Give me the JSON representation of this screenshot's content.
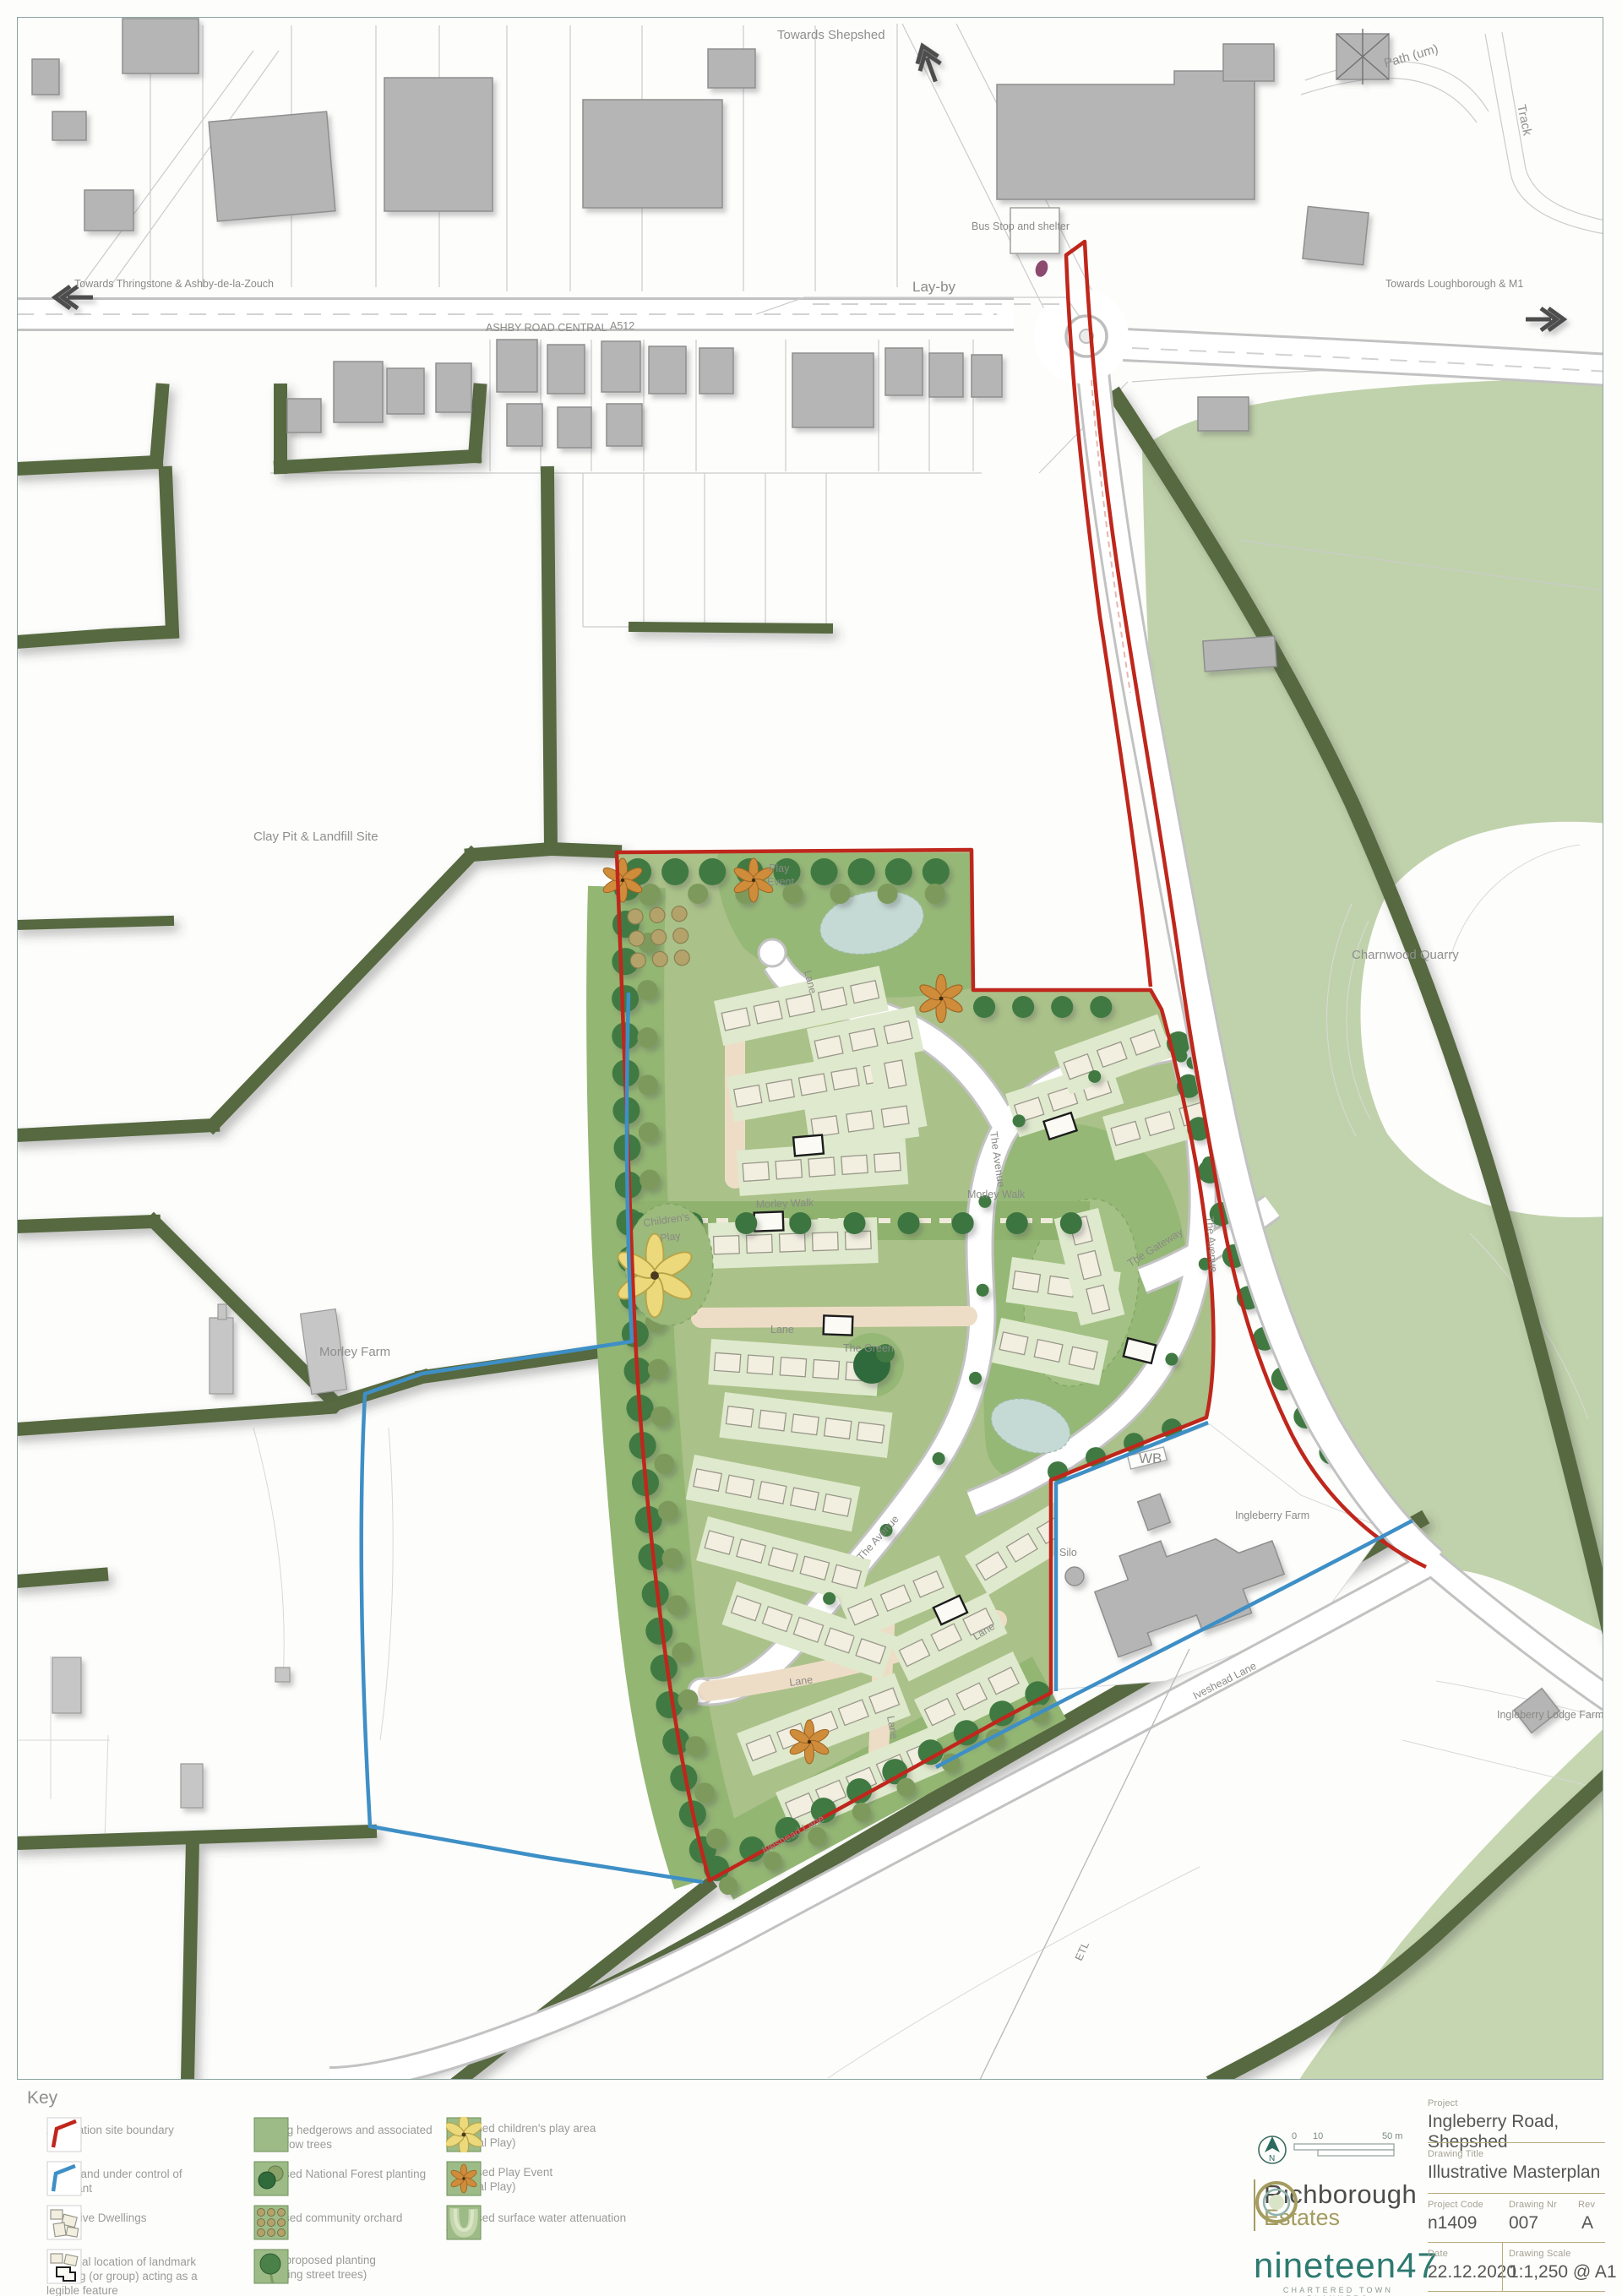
{
  "colors": {
    "site_boundary_red": "#bf271c",
    "other_land_blue": "#3e8fc6",
    "hedgerow_green": "#57693f",
    "site_green": "#aac189",
    "open_space_green": "#96b877",
    "quarry_field_green": "#c0d2ab",
    "tree_dark_green": "#3c7440",
    "tree_olive": "#7d9a5c",
    "garden_green": "#dfe9cd",
    "dwelling_cream": "#f2eee0",
    "drive_salmon": "#eeddc6",
    "building_grey": "#b5b5b5",
    "water_blue": "#c5dad4",
    "play_yellow": "#ecd97c",
    "play_orange": "#cf8c3a",
    "bus_stop_purple": "#8c4a6e",
    "brand_teal": "#2d7a70",
    "brand_olive": "#a59c60",
    "frame_teal": "#8ba3a0"
  },
  "map_labels": {
    "towards_shepshed": "Towards Shepshed",
    "path_um": "Path (um)",
    "track": "Track",
    "towards_thringstone": "Towards Thringstone & Ashby-de-la-Zouch",
    "layby": "Lay-by",
    "ashby_road_central": "ASHBY ROAD CENTRAL",
    "a512": "A512",
    "bus_stop": "Bus Stop and shelter",
    "towards_loughborough": "Towards Loughborough & M1",
    "clay_pit": "Clay Pit & Landfill Site",
    "charnwood_quarry": "Charnwood Quarry",
    "morley_farm": "Morley Farm",
    "wb": "WB",
    "ingleberry_farm": "Ingleberry Farm",
    "silo": "Silo",
    "ingleberry_lodge_farm": "Ingleberry Lodge Farm",
    "etl": "ETL",
    "iveshead_lane_a": "Iveshead Lane",
    "iveshead_lane_b": "Iveshead Lane",
    "the_avenue_a": "The Avenue",
    "the_avenue_b": "The Avenue",
    "the_avenue_c": "The Avenue",
    "morley_walk_a": "Morley Walk",
    "morley_walk_b": "Morley Walk",
    "lane_a": "Lane",
    "lane_b": "Lane",
    "lane_c": "Lane",
    "lane_d": "Lane",
    "lane_e": "Lane",
    "the_green": "The Green",
    "the_gateway": "The Gateway",
    "childrens_play_1": "Children's",
    "childrens_play_2": "Play",
    "play_event_1": "Play",
    "play_event_2": "Event"
  },
  "key": {
    "title": "Key",
    "items": [
      {
        "id": "application-site-boundary",
        "label": "Application site boundary"
      },
      {
        "id": "other-land",
        "label": "Other land under control of applicant"
      },
      {
        "id": "indicative-dwellings",
        "label": "Indicative Dwellings"
      },
      {
        "id": "landmark-building",
        "label": "Potential location of landmark building (or group) acting as a legible feature"
      },
      {
        "id": "existing-hedgerows",
        "label": "Existing hedgerows and associated hedgerow trees"
      },
      {
        "id": "national-forest-planting",
        "label": "Proposed National Forest planting"
      },
      {
        "id": "community-orchard",
        "label": "Proposed community orchard"
      },
      {
        "id": "other-planting",
        "label": "Other proposed planting",
        "sub": "(Including street trees)"
      },
      {
        "id": "childrens-play-area",
        "label": "Proposed children's play area",
        "sub": "(Natural Play)"
      },
      {
        "id": "play-event",
        "label": "Proposed Play Event",
        "sub": "(Natural Play)"
      },
      {
        "id": "surface-water",
        "label": "Proposed surface water attenuation feature"
      }
    ]
  },
  "title_block": {
    "project_label": "Project",
    "project_value": "Ingleberry Road, Shepshed",
    "drawing_title_label": "Drawing Title",
    "drawing_title_value": "Illustrative Masterplan",
    "project_code_label": "Project Code",
    "project_code_value": "n1409",
    "drawing_nr_label": "Drawing Nr",
    "drawing_nr_value": "007",
    "rev_label": "Rev",
    "rev_value": "A",
    "date_label": "Date",
    "date_value": "22.12.2020",
    "scale_label": "Drawing Scale",
    "scale_value": "1:1,250 @ A1",
    "brand_primary": "Richborough",
    "brand_secondary": "Estates",
    "brand_planner": "nineteen47",
    "brand_planner_sub1": "CHARTERED TOWN PLANNERS",
    "brand_planner_sub2": "& URBAN DESIGNERS",
    "north_letter": "N",
    "scalebar": {
      "t0": "0",
      "t10": "10",
      "t50": "50 m"
    }
  }
}
